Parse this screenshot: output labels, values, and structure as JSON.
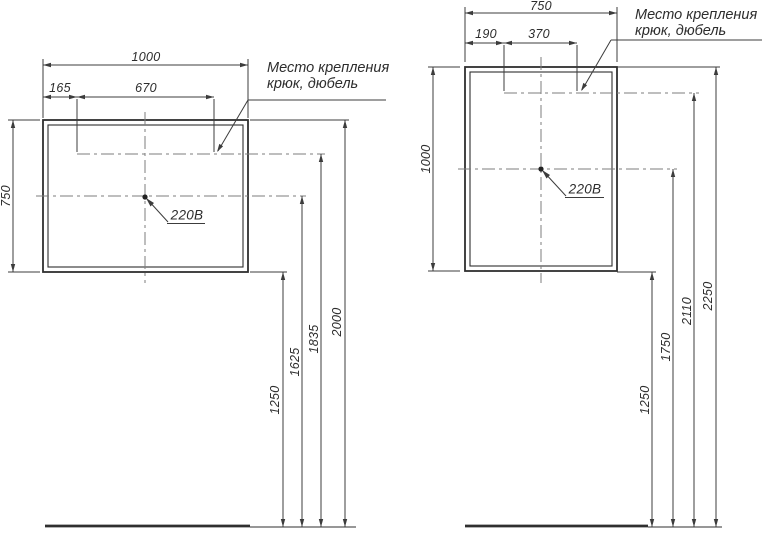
{
  "notes": {
    "mount_line1": "Место крепления",
    "mount_line2": "крюк, дюбель",
    "outlet": "220В"
  },
  "left_mirror": {
    "width": "1000",
    "height": "750",
    "hook_left_offset": "165",
    "hook_spacing": "670",
    "heights_from_floor": {
      "bottom": "1250",
      "outlet": "1625",
      "hooks": "1835",
      "top": "2000"
    }
  },
  "right_mirror": {
    "width": "750",
    "height": "1000",
    "hook_left_offset": "190",
    "hook_spacing": "370",
    "heights_from_floor": {
      "bottom": "1250",
      "outlet": "1750",
      "hooks": "2110",
      "top": "2250"
    }
  }
}
